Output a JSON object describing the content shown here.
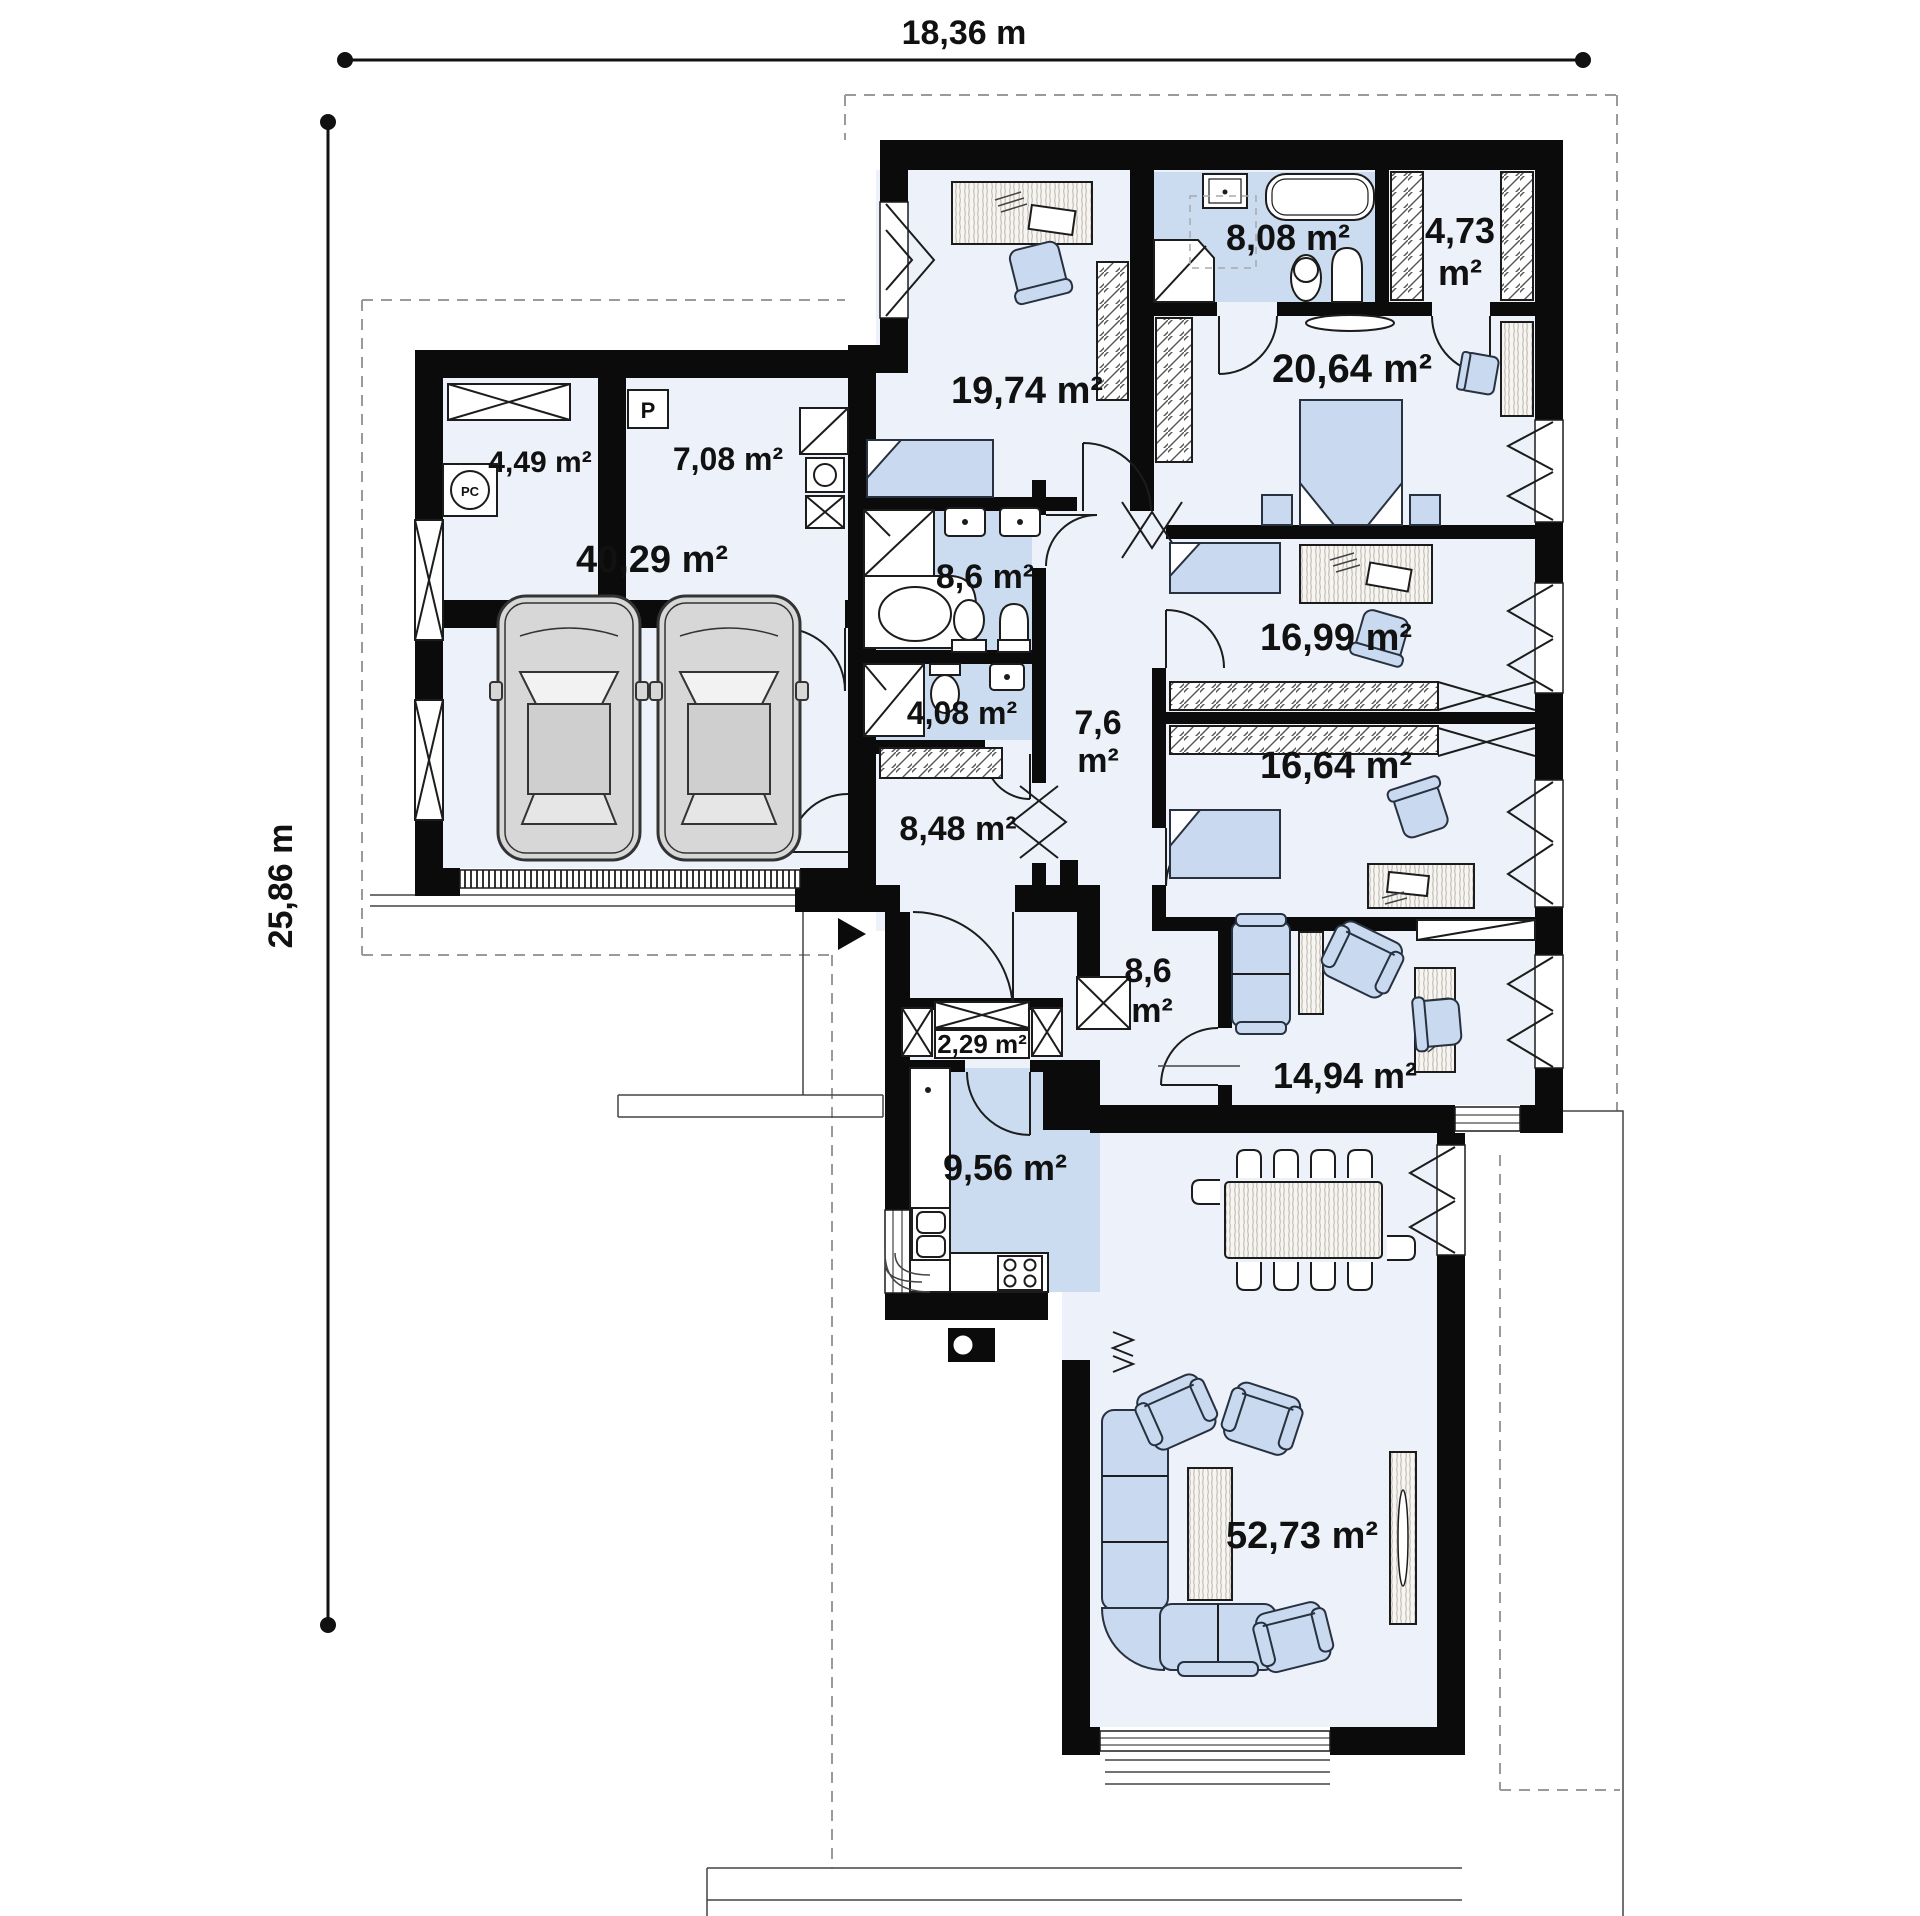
{
  "plan_title": "Single-storey house floor plan",
  "dimensions": {
    "width": "18,36 m",
    "depth": "25,86 m"
  },
  "markers": {
    "parking": "P",
    "boiler": "PC"
  },
  "colors": {
    "wall": "#0b0b0b",
    "floor": "#edf1f9",
    "wet_floor": "#ccdcf0",
    "furniture": "#c9d9f0",
    "dash": "#9a9a9a"
  },
  "rooms": [
    {
      "id": "utility",
      "line1": "4,49 m²",
      "line2": "",
      "area_m2": 4.49
    },
    {
      "id": "storage",
      "line1": "7,08 m²",
      "line2": "",
      "area_m2": 7.08
    },
    {
      "id": "garage",
      "line1": "40,29 m²",
      "line2": "",
      "area_m2": 40.29
    },
    {
      "id": "bedroom-1",
      "line1": "19,74 m²",
      "line2": "",
      "area_m2": 19.74
    },
    {
      "id": "bathroom-main",
      "line1": "8,08 m²",
      "line2": "",
      "area_m2": 8.08
    },
    {
      "id": "wardrobe",
      "line1": "4,73",
      "line2": "m²",
      "area_m2": 4.73
    },
    {
      "id": "bedroom-master",
      "line1": "20,64 m²",
      "line2": "",
      "area_m2": 20.64
    },
    {
      "id": "bathroom-2",
      "line1": "8,6 m²",
      "line2": "",
      "area_m2": 8.6
    },
    {
      "id": "bedroom-2",
      "line1": "16,99 m²",
      "line2": "",
      "area_m2": 16.99
    },
    {
      "id": "wc",
      "line1": "4,08 m²",
      "line2": "",
      "area_m2": 4.08
    },
    {
      "id": "hall-upper",
      "line1": "7,6",
      "line2": "m²",
      "area_m2": 7.6
    },
    {
      "id": "bedroom-3",
      "line1": "16,64 m²",
      "line2": "",
      "area_m2": 16.64
    },
    {
      "id": "corridor",
      "line1": "8,48 m²",
      "line2": "",
      "area_m2": 8.48
    },
    {
      "id": "hall-entry",
      "line1": "8,6",
      "line2": "m²",
      "area_m2": 8.6
    },
    {
      "id": "pantry",
      "line1": "2,29 m²",
      "line2": "",
      "area_m2": 2.29
    },
    {
      "id": "office",
      "line1": "14,94 m²",
      "line2": "",
      "area_m2": 14.94
    },
    {
      "id": "kitchen",
      "line1": "9,56 m²",
      "line2": "",
      "area_m2": 9.56
    },
    {
      "id": "living-room",
      "line1": "52,73 m²",
      "line2": "",
      "area_m2": 52.73
    }
  ]
}
